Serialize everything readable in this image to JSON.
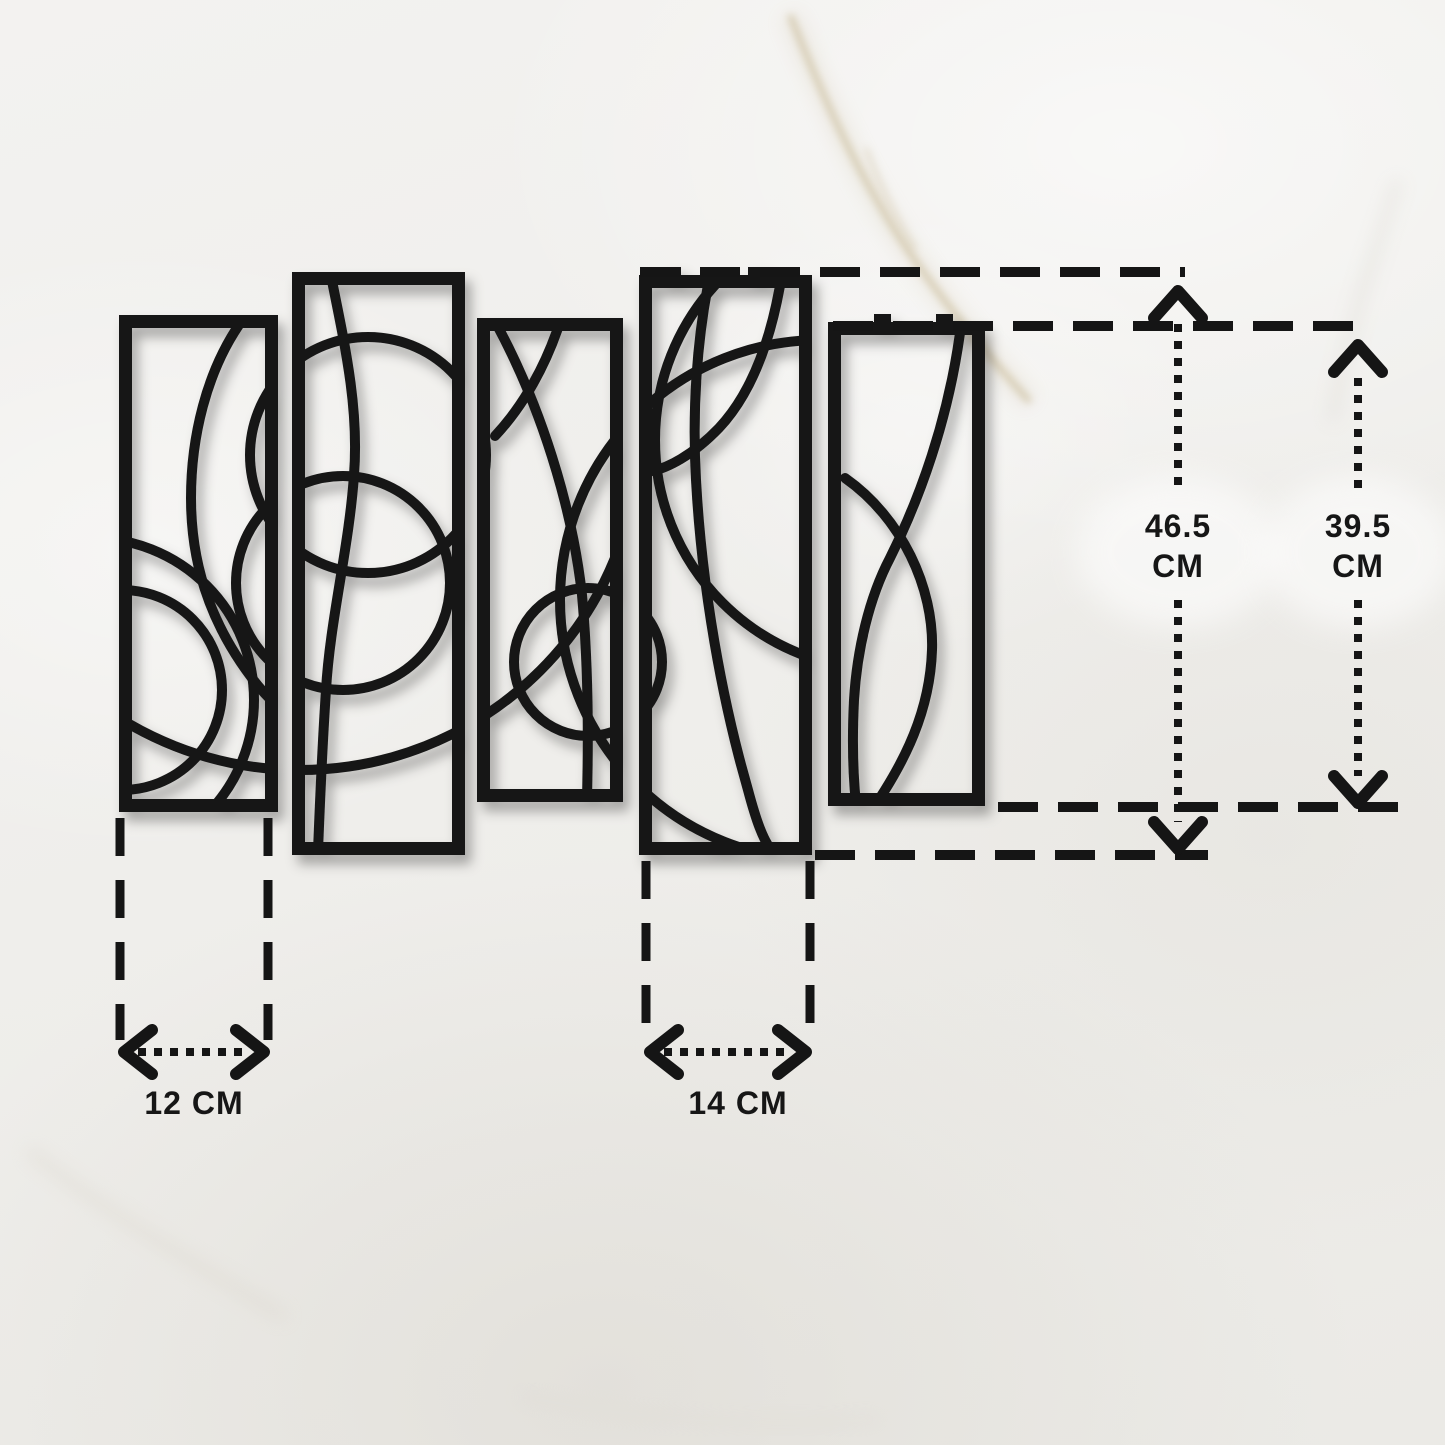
{
  "image": {
    "kind": "product-dimensions-illustration",
    "subject": "Set of 5 black metal abstract wall-art panels hung on a white marble wall",
    "panel_count": 5
  },
  "colors": {
    "artwork_black": "#161616",
    "annotation_ink": "#151515",
    "wall_white": "#efeeeb",
    "marble_vein_tan": "#c3b189"
  },
  "dimensions": {
    "large_panel_height": {
      "value": "46.5",
      "unit": "CM"
    },
    "small_panel_height": {
      "value": "39.5",
      "unit": "CM"
    },
    "small_panel_width": "12 CM",
    "large_panel_width": "14 CM"
  }
}
